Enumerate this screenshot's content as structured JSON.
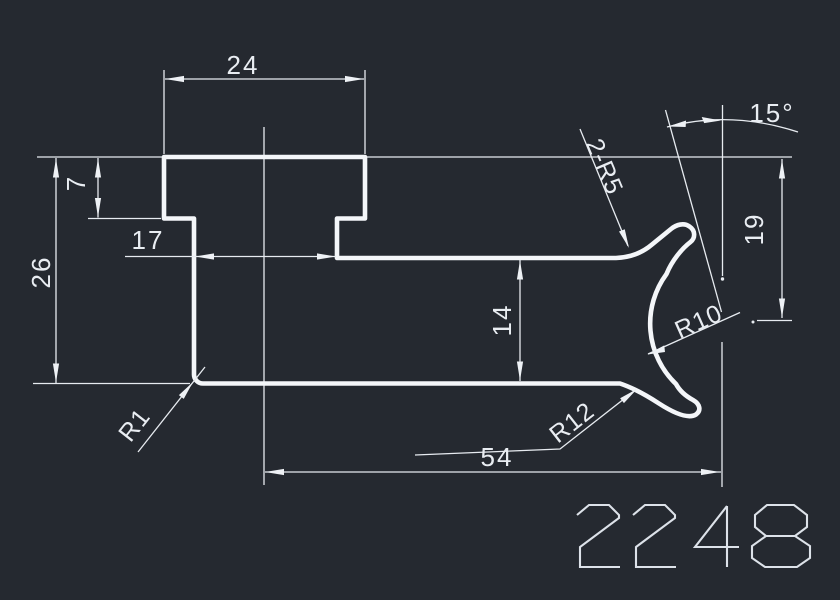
{
  "colors": {
    "background": "#252930",
    "profile_line": "#f4f6f9",
    "dimension_line": "#e7ebf0"
  },
  "drawing": {
    "part_number": "2248",
    "dims": {
      "top_width": "24",
      "hat_height": "7",
      "neck_width": "17",
      "total_height": "26",
      "web_height": "14",
      "right_height": "19",
      "bottom_width": "54",
      "lip_angle": "15°",
      "lip_fillets": "2-R5",
      "hook_inner_radius": "R10",
      "hook_outer_radius": "R12",
      "corner_radius": "R1"
    }
  }
}
